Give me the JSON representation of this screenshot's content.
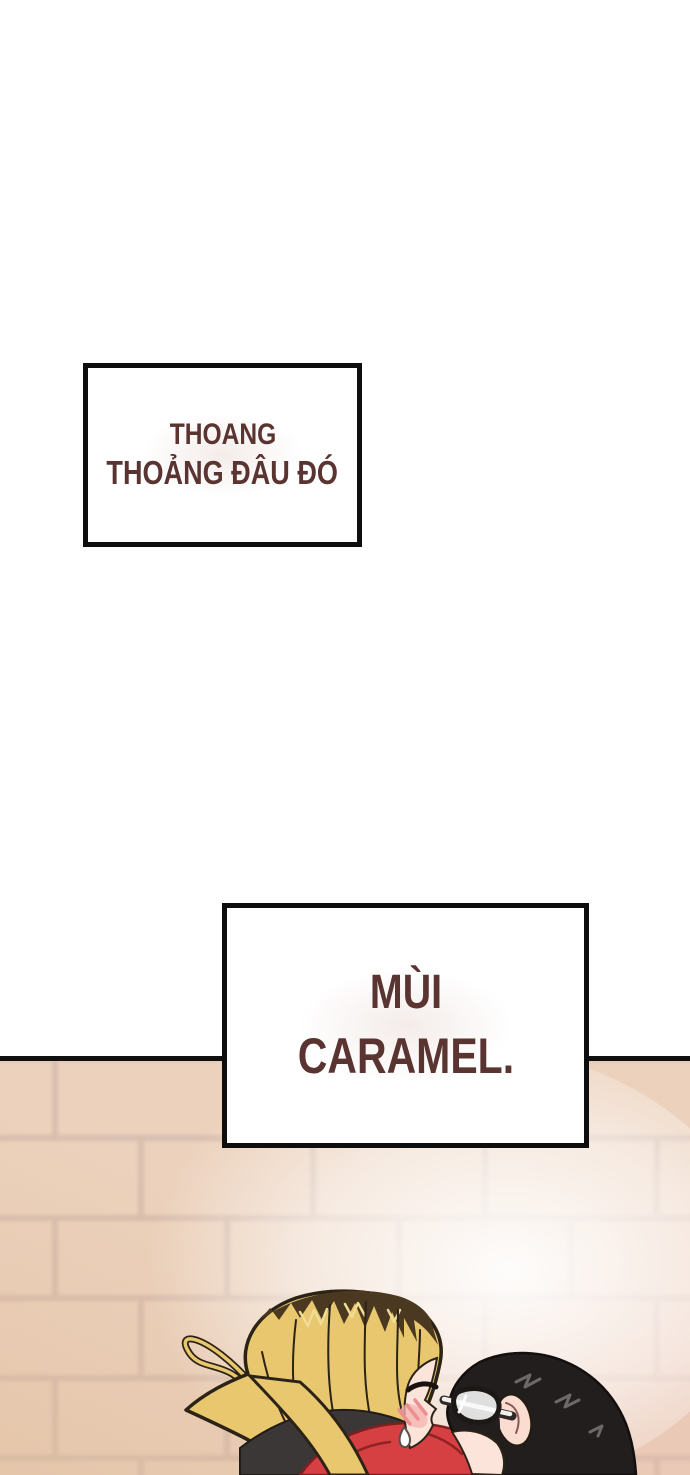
{
  "comic": {
    "speech_boxes": [
      {
        "lines": [
          "THOANG",
          "THOẢNG ĐÂU ĐÓ"
        ]
      },
      {
        "lines": [
          "MÙI",
          "CARAMEL."
        ]
      }
    ],
    "colors": {
      "page_bg": "#ffffff",
      "caption_text": "#5a3431",
      "caption_border": "#0e0e0e",
      "caption_bg": "#ffffff",
      "wall_brick": "#ecd2bd",
      "wall_mortar": "#d8bead",
      "wall_glow": "#ffffff",
      "hair_blonde": "#e8c76f",
      "hair_roots_dark": "#4a3920",
      "hair_black": "#211e1d",
      "hair_shine_gray": "#6c6866",
      "skin": "#fce4da",
      "blush": "#ec8f93",
      "hood_dark": "#3b3736",
      "jacket_red": "#d64043",
      "line_outline": "#2b2315"
    }
  }
}
